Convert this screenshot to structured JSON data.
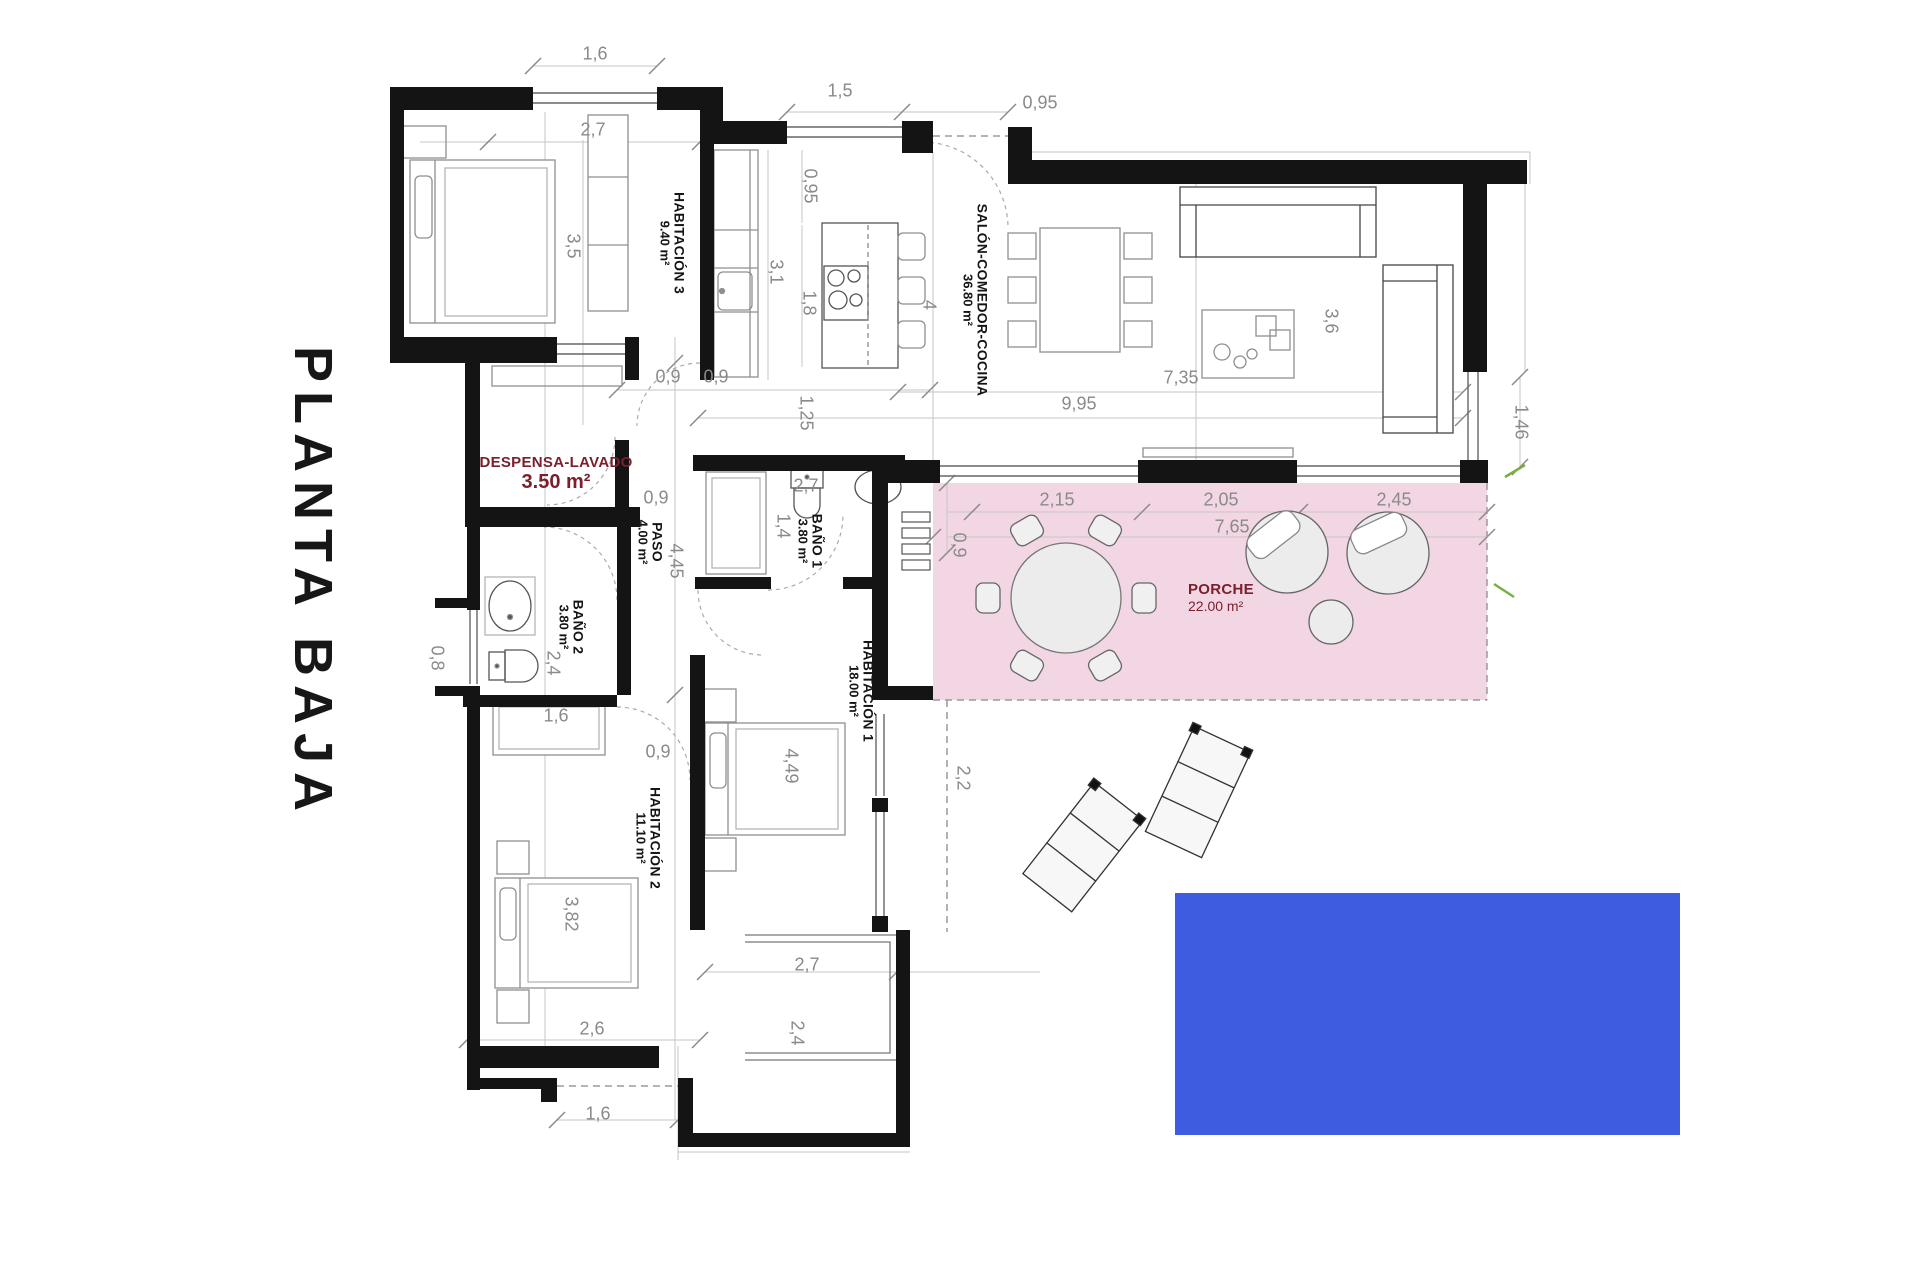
{
  "title": "PLANTA BAJA",
  "rooms": {
    "hab3": {
      "name": "HABITACIÓN 3",
      "area": "9.40 m²"
    },
    "salon": {
      "name": "SALÓN-COMEDOR-COCINA",
      "area": "36.80 m²"
    },
    "despensa": {
      "name": "DESPENSA-LAVADO",
      "area": "3.50 m²"
    },
    "paso": {
      "name": "PASO",
      "area": "4.00 m²"
    },
    "bano1": {
      "name": "BAÑO 1",
      "area": "3.80 m²"
    },
    "bano2": {
      "name": "BAÑO 2",
      "area": "3.80 m²"
    },
    "hab1": {
      "name": "HABITACIÓN 1",
      "area": "18.00 m²"
    },
    "hab2": {
      "name": "HABITACIÓN 2",
      "area": "11.10 m²"
    },
    "porche": {
      "name": "PORCHE",
      "area": "22.00 m²"
    }
  },
  "dims": {
    "d1": "1,6",
    "d2": "2,7",
    "d3": "3,5",
    "d4": "1,5",
    "d5": "0,95",
    "d6": "0,95",
    "d7": "3,1",
    "d8": "1,8",
    "d9": "4",
    "d10": "0,9",
    "d11": "0,9",
    "d12": "1,25",
    "d13": "0,9",
    "d14": "9,95",
    "d15": "7,35",
    "d16": "3,6",
    "d17": "1,46",
    "d18": "2,15",
    "d19": "2,05",
    "d20": "2,45",
    "d21": "7,65",
    "d22": "0,9",
    "d23": "4,45",
    "d24": "2,7",
    "d25": "1,4",
    "d26": "0,8",
    "d27": "2,4",
    "d28": "1,6",
    "d29": "0,9",
    "d30": "3,82",
    "d31": "4,49",
    "d32": "2,7",
    "d33": "2,4",
    "d34": "2,2",
    "d35": "2,6",
    "d36": "1,6"
  },
  "colors": {
    "porch": "#f2d6e3",
    "pool": "#3d5ce0",
    "accent": "#7a1f2b",
    "dimension_text": "#8a8a8a",
    "walls": "#141414",
    "landscape_mark": "#76b041"
  }
}
